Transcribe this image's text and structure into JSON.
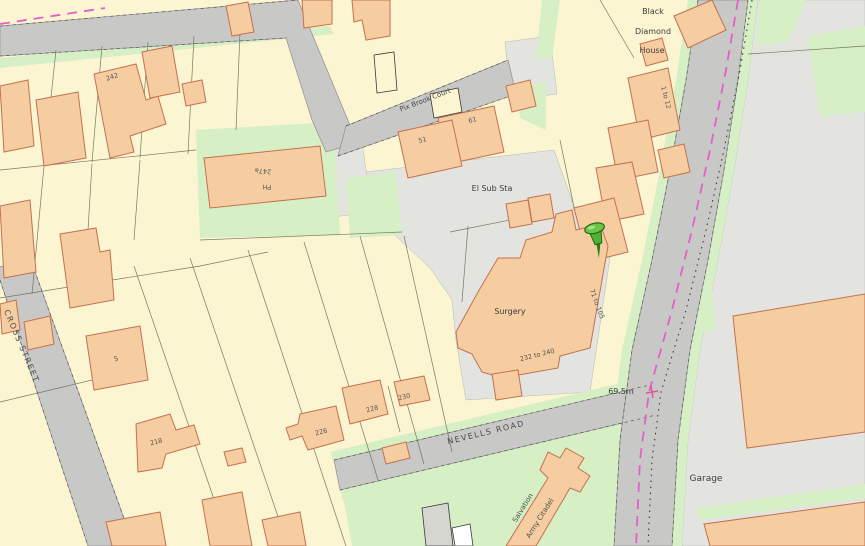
{
  "map": {
    "description": "Ordnance-Survey-style property location map with pin",
    "roads": {
      "nevells": "NEVELLS ROAD",
      "cross": "CROSS STREET",
      "pix_brook": "Pix Brook Court"
    },
    "places": {
      "black1": "Black",
      "black2": "Diamond",
      "black3": "House",
      "el_sub_sta": "El Sub Sta",
      "surgery": "Surgery",
      "garage": "Garage",
      "salvation1": "Salvation",
      "salvation2": "Army Citadel",
      "ph_number": "247a",
      "ph": "PH"
    },
    "house_numbers": {
      "n242": "242",
      "n5": "5",
      "n218": "218",
      "n226": "226",
      "n228": "228",
      "n230": "230",
      "n51": "51",
      "n61": "61"
    },
    "ranges": {
      "r1_12": "1 to 12",
      "r71_105": "71 to 105",
      "r232_240": "232 to 240"
    },
    "spot_height": "69.5m",
    "marker": {
      "name": "green-pushpin",
      "color": "#4fb236"
    },
    "colors": {
      "land": "#fbf5d2",
      "building": "#f5cda1",
      "building_outline": "#c4714f",
      "road": "#c8c8c6",
      "yard": "#e3e3e0",
      "green": "#d6efc5",
      "boundary_dashed": "#e55fc9",
      "spot_cross": "#e0559f"
    }
  }
}
